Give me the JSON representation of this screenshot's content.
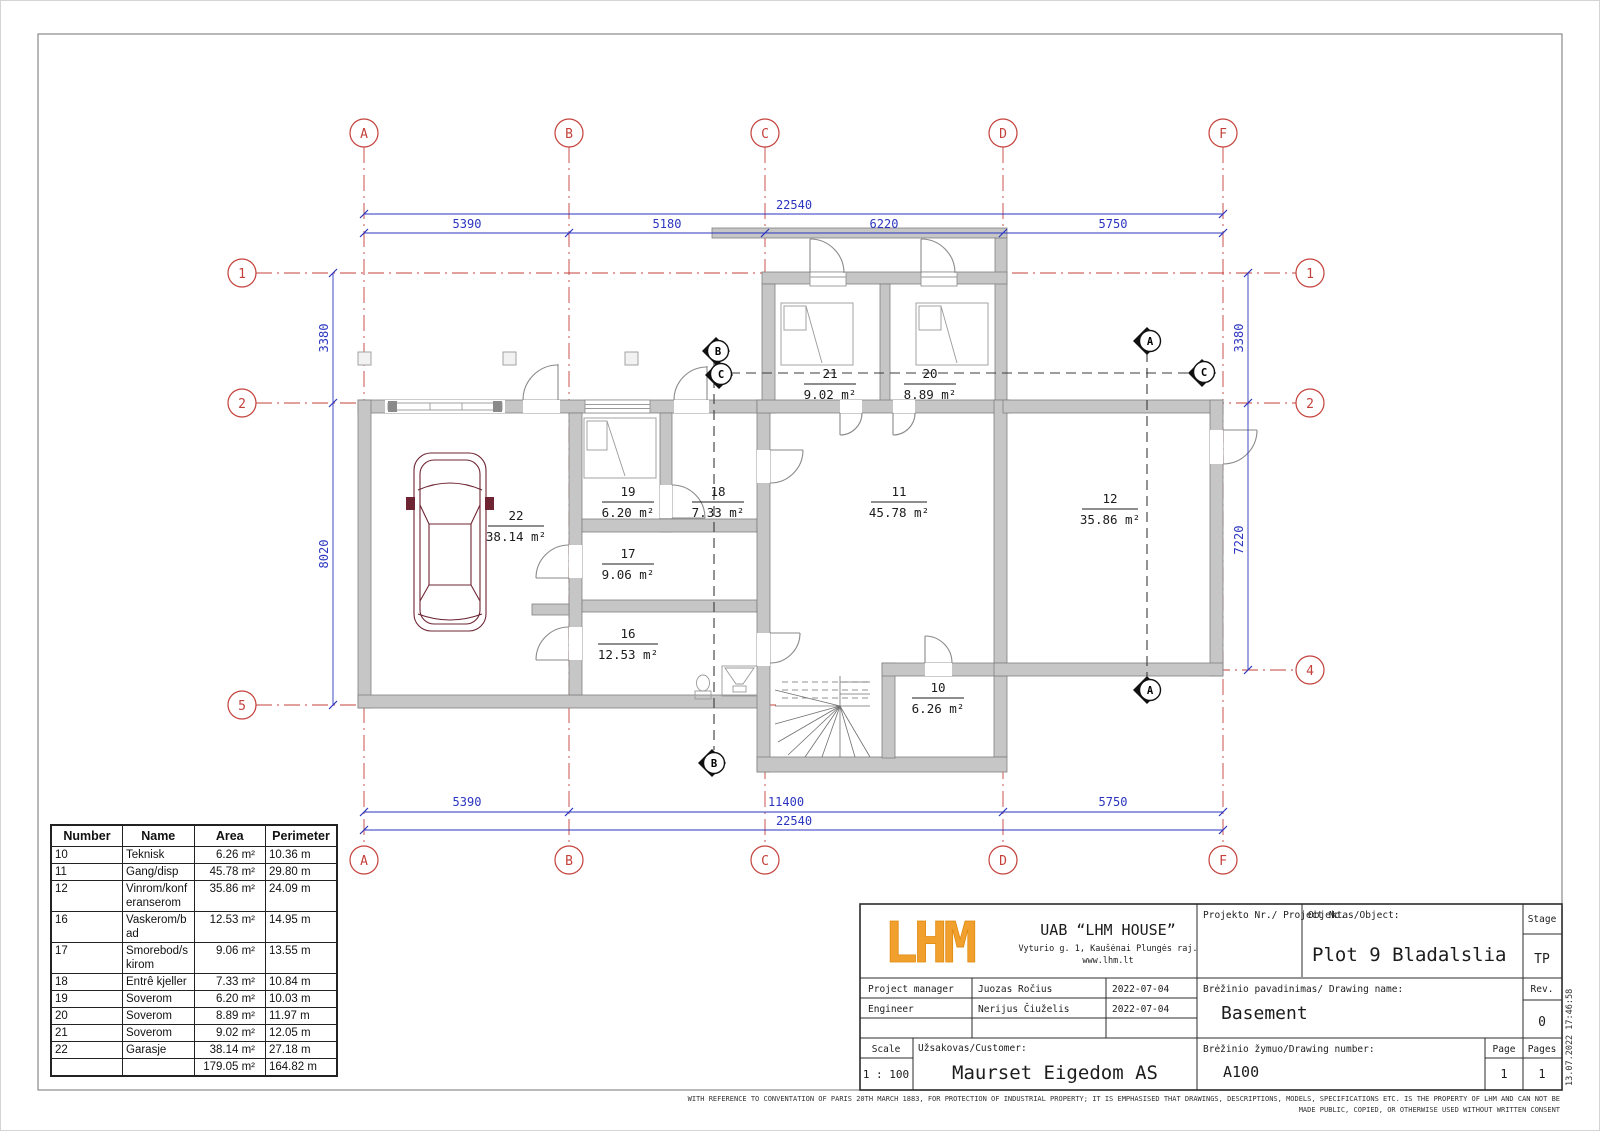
{
  "plan": {
    "grid": {
      "cols": [
        "A",
        "B",
        "C",
        "D",
        "F"
      ],
      "rows_left": [
        "1",
        "2",
        "5"
      ],
      "rows_right": [
        "1",
        "2",
        "4"
      ]
    },
    "dims": {
      "top_total": "22540",
      "top_segs": [
        "5390",
        "5180",
        "6220",
        "5750"
      ],
      "bottom_segs": [
        "5390",
        "11400",
        "5750"
      ],
      "bottom_total": "22540",
      "left": [
        "3380",
        "8020"
      ],
      "right": [
        "3380",
        "7220"
      ]
    },
    "rooms": [
      {
        "number": "22",
        "area": "38.14 m²"
      },
      {
        "number": "19",
        "area": "6.20 m²"
      },
      {
        "number": "18",
        "area": "7.33 m²"
      },
      {
        "number": "17",
        "area": "9.06 m²"
      },
      {
        "number": "16",
        "area": "12.53 m²"
      },
      {
        "number": "21",
        "area": "9.02 m²"
      },
      {
        "number": "20",
        "area": "8.89 m²"
      },
      {
        "number": "11",
        "area": "45.78 m²"
      },
      {
        "number": "12",
        "area": "35.86 m²"
      },
      {
        "number": "10",
        "area": "6.26 m²"
      }
    ],
    "sections": {
      "a": "A",
      "b": "B",
      "c": "C"
    }
  },
  "schedule_table": {
    "headers": [
      "Number",
      "Name",
      "Area",
      "Perimeter"
    ],
    "rows": [
      [
        "10",
        "Teknisk",
        "6.26 m²",
        "10.36 m"
      ],
      [
        "11",
        "Gang/disp",
        "45.78 m²",
        "29.80 m"
      ],
      [
        "12",
        "Vinrom/konferanserom",
        "35.86 m²",
        "24.09 m"
      ],
      [
        "16",
        "Vaskerom/bad",
        "12.53 m²",
        "14.95 m"
      ],
      [
        "17",
        "Smorebod/skirom",
        "9.06 m²",
        "13.55 m"
      ],
      [
        "18",
        "Entrê kjeller",
        "7.33 m²",
        "10.84 m"
      ],
      [
        "19",
        "Soverom",
        "6.20 m²",
        "10.03 m"
      ],
      [
        "20",
        "Soverom",
        "8.89 m²",
        "11.97 m"
      ],
      [
        "21",
        "Soverom",
        "9.02 m²",
        "12.05 m"
      ],
      [
        "22",
        "Garasje",
        "38.14 m²",
        "27.18 m"
      ]
    ],
    "total": [
      "",
      "",
      "179.05 m²",
      "164.82 m"
    ]
  },
  "title_block": {
    "logo_text": "LHM",
    "logo_color": "#f1a02e",
    "company": "UAB “LHM HOUSE”",
    "address": "Vyturio g. 1, Kaušėnai Plungės raj.",
    "website": "www.lhm.lt",
    "project_manager_label": "Project manager",
    "project_manager": "Juozas Ročius",
    "project_manager_date": "2022-07-04",
    "engineer_label": "Engineer",
    "engineer": "Nerijus Čiuželis",
    "engineer_date": "2022-07-04",
    "scale_label": "Scale",
    "scale_value": "1 : 100",
    "customer_label": "Užsakovas/Customer:",
    "customer": "Maurset Eigedom AS",
    "project_no_label": "Projekto Nr./ Project No.",
    "object_label": "Objektas/Object:",
    "object_value": "Plot 9 Bladalslia",
    "stage_label": "Stage",
    "stage_value": "TP",
    "drawing_name_label": "Brėžinio pavadinimas/ Drawing name:",
    "drawing_name": "Basement",
    "rev_label": "Rev.",
    "rev_value": "0",
    "drawing_number_label": "Brėžinio žymuo/Drawing number:",
    "drawing_number": "A100",
    "page_label": "Page",
    "page_value": "1",
    "pages_label": "Pages",
    "pages_value": "1"
  },
  "footer": {
    "disclaimer_line1": "WITH REFERENCE TO CONVENTATION OF PARIS 20TH MARCH 1883, FOR PROTECTION OF INDUSTRIAL PROPERTY; IT IS EMPHASISED THAT DRAWINGS, DESCRIPTIONS, MODELS, SPECIFICATIONS ETC. IS THE PROPERTY OF LHM AND CAN NOT BE",
    "disclaimer_line2": "MADE PUBLIC, COPIED, OR OTHERWISE USED WITHOUT WRITTEN CONSENT",
    "timestamp": "13.07.2022 17:46:58"
  }
}
